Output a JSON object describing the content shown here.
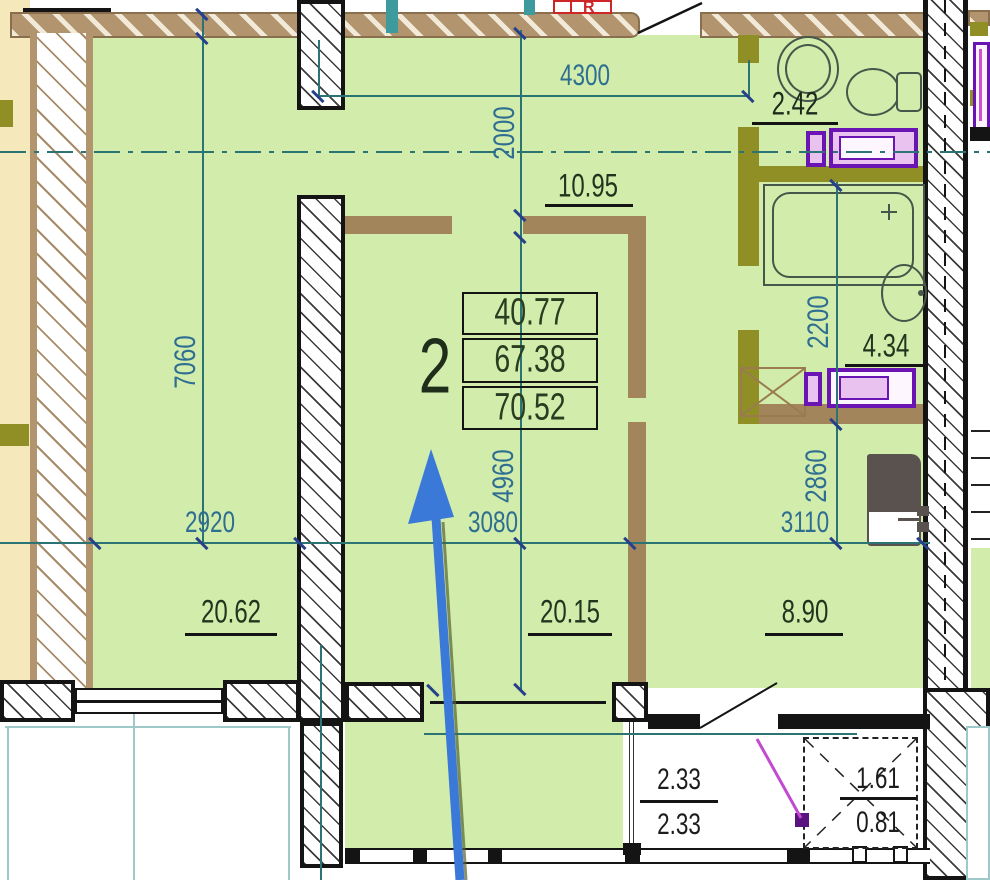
{
  "palette": {
    "c-green": "#d2ecac",
    "c-cream": "#f5e8ba",
    "c-tan": "#b2946f",
    "c-tanDark": "#8a6f4e",
    "c-brown": "#a3855c",
    "c-olive": "#8f8f26",
    "c-wall": "#141414",
    "c-dimLine": "#2c7474",
    "c-dimText": "#2e6e91",
    "c-areaText": "#20351d",
    "c-blue": "#3b79d9",
    "c-purple": "#6b14b4",
    "c-magentaFill": "#eac2ef",
    "c-magentaBright": "#d14fd1",
    "c-red": "#cc2626",
    "c-cyan": "#3d9b9e",
    "c-fixture": "#47564a",
    "c-tealLight": "#9fc8c8",
    "c-grayDark": "#5a524e"
  },
  "apartment": {
    "unit_number": "2",
    "stats": [
      "40.77",
      "67.38",
      "70.52"
    ],
    "rooms": {
      "hall_area": "10.95",
      "wc_area": "2.42",
      "bath_area": "4.34",
      "left_room_area": "20.62",
      "living_area": "20.15",
      "kitchen_area": "8.90"
    },
    "balcony": {
      "left_top": "2.33",
      "left_bottom": "2.33",
      "right_top": "1.61",
      "right_bottom": "0.81"
    },
    "entry_marker": "R"
  },
  "dimensions": {
    "top_width": "4300",
    "hall_depth": "2000",
    "left_height": "7060",
    "left_width": "2920",
    "living_width": "3080",
    "living_height": "4960",
    "bath_height": "2200",
    "kitchen_height": "2860",
    "kitchen_width": "3110"
  }
}
